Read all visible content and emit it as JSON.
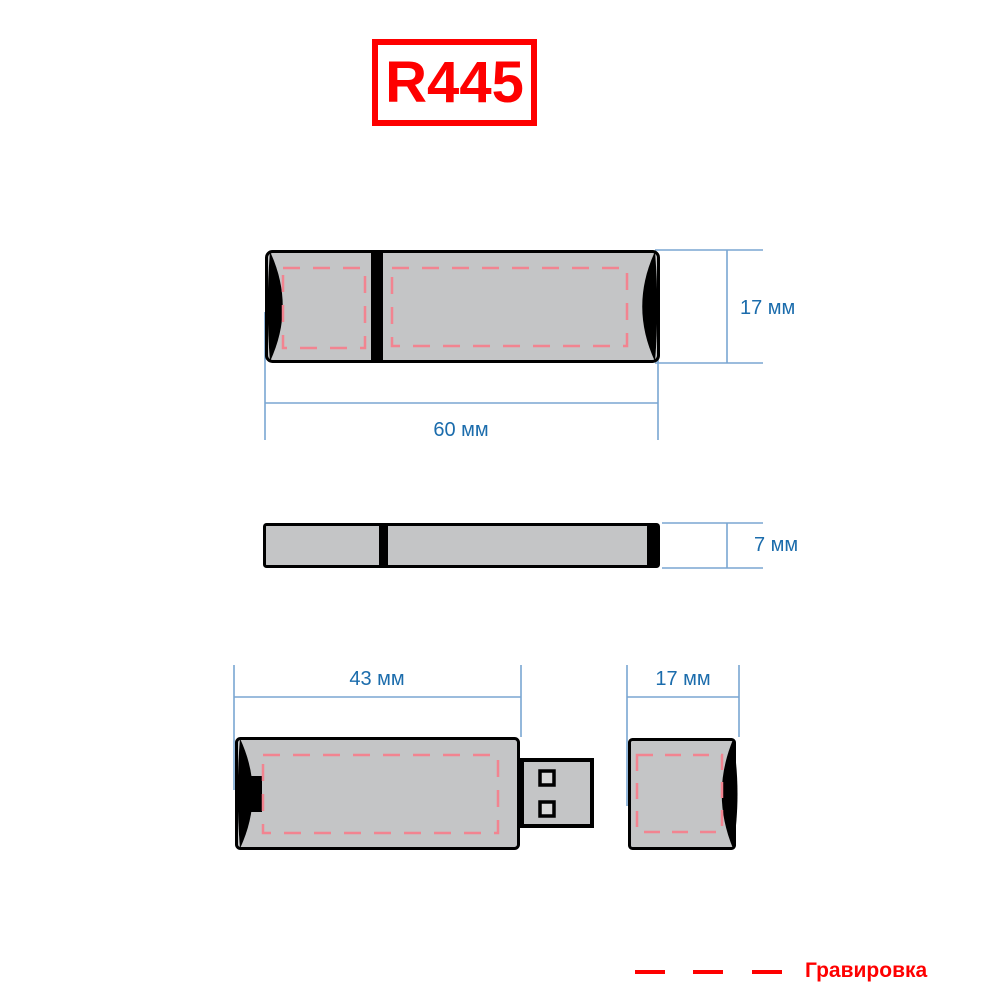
{
  "title": {
    "model": "R445"
  },
  "drawing": {
    "product": "usb-flash-drive",
    "views": {
      "top_view": {
        "height_label": "17 мм",
        "width_label": "60 мм"
      },
      "side_view": {
        "height_label": "7 мм"
      },
      "body_view": {
        "width_label": "43 мм"
      },
      "cap_view": {
        "width_label": "17 мм"
      }
    }
  },
  "legend": {
    "label": "Гравировка"
  },
  "colors": {
    "accent_red": "#fe0000",
    "dim_text_blue": "#1b6cac",
    "dim_line_blue": "#7aa6d2",
    "engraving_pink": "#f28490",
    "body_gray": "#c4c5c6",
    "outline_black": "#000000"
  }
}
